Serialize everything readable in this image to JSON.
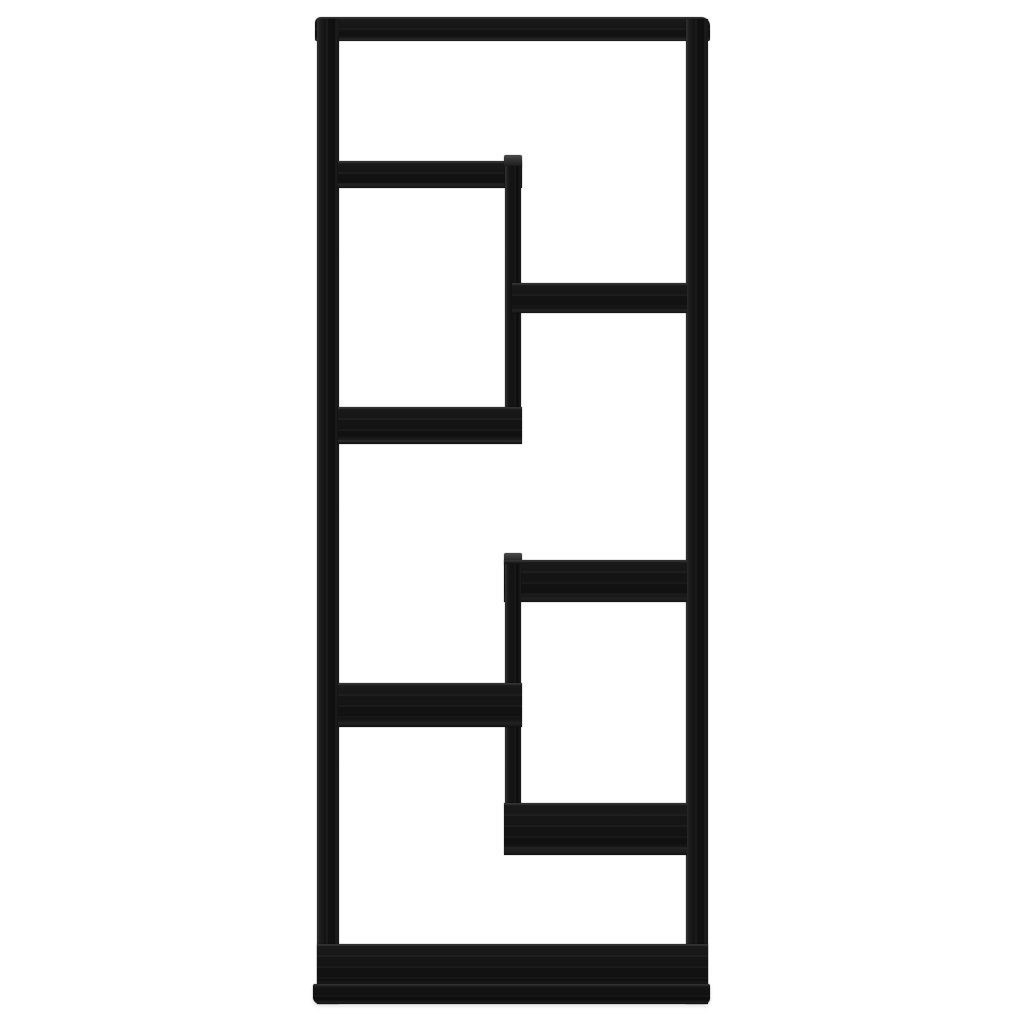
{
  "scene": {
    "type": "product-photo",
    "subject": "black wood-effect asymmetric wall shelf bookcase, front view, six open compartments",
    "background_color": "#ffffff",
    "wood_color": "#151515",
    "wood_highlight_color": "#4b4b4b",
    "canvas": {
      "width": 1024,
      "height": 1024
    }
  },
  "parts": [
    {
      "name": "top-bar",
      "x": 315,
      "y": 17,
      "w": 395,
      "h": 24,
      "grain": "h",
      "variant": "frame-top"
    },
    {
      "name": "left-rail",
      "x": 317,
      "y": 19,
      "w": 22,
      "h": 985,
      "grain": "v",
      "variant": "rail"
    },
    {
      "name": "right-rail",
      "x": 686,
      "y": 19,
      "w": 22,
      "h": 985,
      "grain": "v",
      "variant": "rail"
    },
    {
      "name": "shelf-top-left",
      "x": 338,
      "y": 161,
      "w": 184,
      "h": 27,
      "grain": "h",
      "variant": "shelf"
    },
    {
      "name": "divider-upper-cap",
      "x": 504,
      "y": 155,
      "w": 18,
      "h": 12,
      "grain": "v",
      "variant": "cap"
    },
    {
      "name": "divider-upper",
      "x": 505,
      "y": 166,
      "w": 16,
      "h": 277,
      "grain": "v",
      "variant": "rail"
    },
    {
      "name": "shelf-upper-right",
      "x": 512,
      "y": 283,
      "w": 175,
      "h": 30,
      "grain": "h",
      "variant": "shelf"
    },
    {
      "name": "shelf-middle-left",
      "x": 338,
      "y": 407,
      "w": 184,
      "h": 37,
      "grain": "h",
      "variant": "shelf"
    },
    {
      "name": "divider-lower-cap",
      "x": 504,
      "y": 553,
      "w": 18,
      "h": 12,
      "grain": "v",
      "variant": "cap"
    },
    {
      "name": "shelf-middle-right",
      "x": 504,
      "y": 560,
      "w": 183,
      "h": 42,
      "grain": "h",
      "variant": "shelf"
    },
    {
      "name": "divider-lower",
      "x": 505,
      "y": 564,
      "w": 16,
      "h": 290,
      "grain": "v",
      "variant": "rail"
    },
    {
      "name": "shelf-lower-left",
      "x": 338,
      "y": 683,
      "w": 184,
      "h": 44,
      "grain": "h",
      "variant": "shelf"
    },
    {
      "name": "shelf-bottom-right",
      "x": 504,
      "y": 803,
      "w": 183,
      "h": 52,
      "grain": "h",
      "variant": "shelf"
    },
    {
      "name": "bottom-slab",
      "x": 317,
      "y": 944,
      "w": 391,
      "h": 46,
      "grain": "h",
      "variant": "shelf"
    },
    {
      "name": "base-lip",
      "x": 313,
      "y": 984,
      "w": 397,
      "h": 20,
      "grain": "h",
      "variant": "base"
    }
  ]
}
